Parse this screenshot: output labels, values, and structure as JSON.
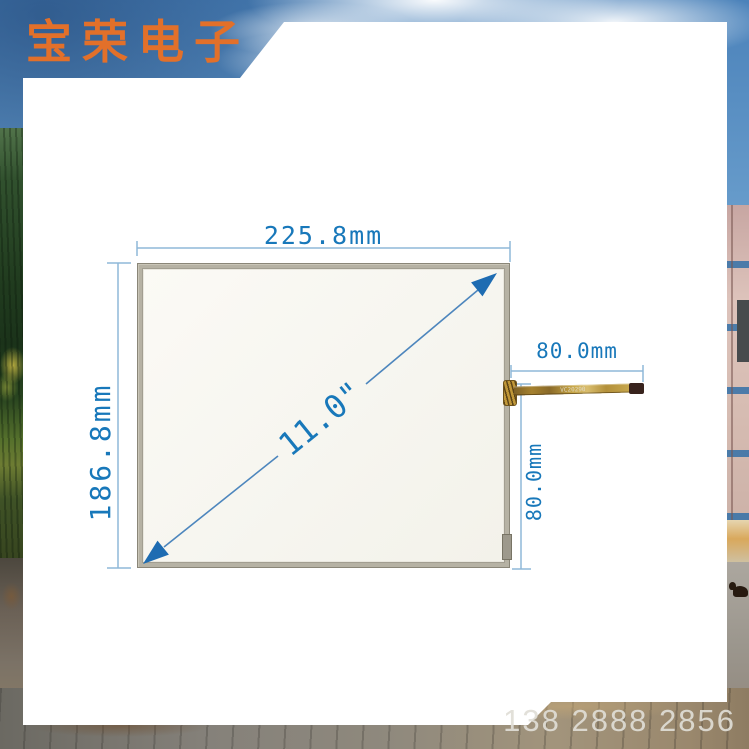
{
  "banner": {
    "company_name": "宝荣电子"
  },
  "diagram": {
    "width_label": "225.8mm",
    "height_label": "186.8mm",
    "diagonal_label": "11.0\"",
    "cable_length_label": "80.0mm",
    "cable_offset_label": "80.0mm",
    "cable_marking": "VC20290"
  },
  "contact": {
    "phone": "138 2888 2856"
  },
  "colors": {
    "dimension_text_blue": "#1878ba",
    "dimension_line_blue": "#8fb8d8",
    "arrow_fill_blue": "#1e6cb2",
    "banner_text_orange": "#e2702a",
    "panel_frame_gray": "#b6b2a4",
    "panel_glass_white": "#f7f6f1",
    "cable_gold": "#c8a748"
  }
}
